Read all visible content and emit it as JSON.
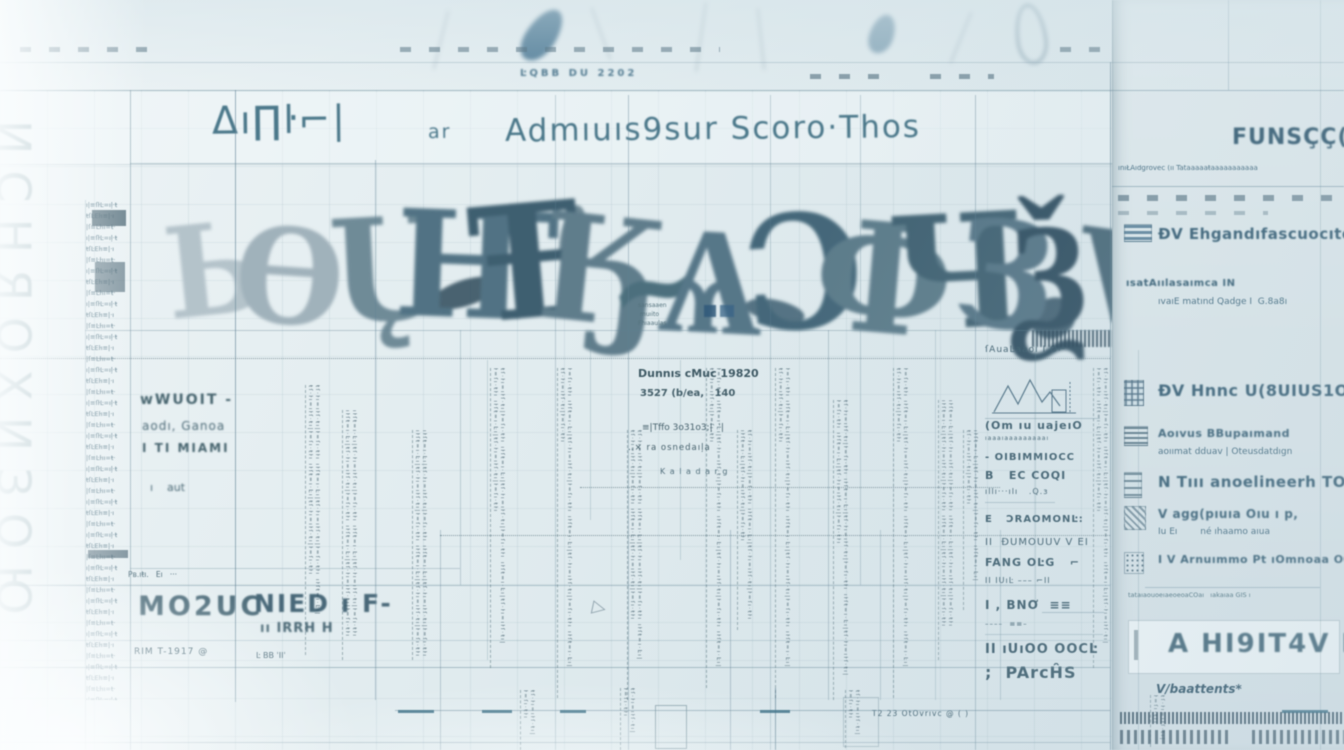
{
  "header": {
    "glyph_prefix": "Δı∏ŀ⌐|",
    "pre_word": "ar",
    "title": "Admıuıs9sur Scoro·Thos"
  },
  "calligraphy": {
    "glyphs": [
      "Ь",
      "Ө",
      "Ų",
      "Ҥ",
      "Ŧ",
      "Ӄ",
      "~",
      "Ѧ",
      "Ɔ",
      "Ф",
      "Ч",
      "З",
      "Ѯ",
      "Ѵ"
    ]
  },
  "left_margin": {
    "vertical_text": "ИСНЯОХИЗОЮ"
  },
  "micro": {
    "rows": [
      "ı|≡ſŀĿ=ıļ·ŧ",
      "ŧſĿEŀı≡|·ı",
      "|ſ≡Ŀŀıı=ŧ·"
    ],
    "column_text": "ıŀſŧ=ı·Ŀı|ŧſ·ŀı=ıŀſ·ŧı|ŀ=ſı·ŧŀı"
  },
  "left_box": {
    "l1": "wWUOIT -",
    "l2": "aodı, Ganoa",
    "l3": "I TI MIAMI",
    "l4": "ı    aut"
  },
  "bottom_left": {
    "tiny_row": "Pʙ.ıŧı.   Eı   ···",
    "cell1": "MO2UC",
    "cell2": "NIED ı F-",
    "cell2_sub": "ıı IRRH H",
    "row1": "RIM T-1917 @",
    "row2": "Ŀ BB ˈIIˈ"
  },
  "center_block": {
    "l1": "Dunnıs cMuc 19820",
    "l2": "3527 (b/ea,   140",
    "l3": "≡|Tffo 3o31o3;|  ˈ|",
    "l4": "‥× ra osnedaıļa",
    "l5": "K a l a d a r g"
  },
  "center_small": {
    "a": "sansaaen",
    "b": "muıito",
    "c": "Fhıaaulas"
  },
  "mid_column": {
    "rows": [
      "ſAuaĿaaoı I O⌐",
      "(Om ıu uajeıO",
      "ıaaaıaaaaaaaaaı",
      "- OIBIMMIOCC",
      "B   EC COQI",
      "ıllı···ılı   .Q.ɜ",
      "E   ƆRAOMONĿ:",
      "II  ĐUMOUUV V EI",
      "FANG OĿG   ⌐",
      "II IUıĿ ––– ⌐II",
      "I , BNƠ  ≡≡",
      "––––  ≡≡–",
      "II ıUıOO OOCĿ",
      ";  PArcĤS"
    ]
  },
  "right_panel": {
    "header": "FUNSÇÇ((",
    "subline": "ınıŁAıdgrovec (ıı Tataaaaaŧaaaaaaaaaaa",
    "items": [
      {
        "label": "ĐV Ehgandıfascuocıto(",
        "sub": "",
        "icon": "list-stripes-icon"
      },
      {
        "label": "ısatAıılasaımca IN",
        "sub": "ıvaıE matınd Qadge I  G.8a8ı",
        "icon": ""
      },
      {
        "label": "ĐV Hnnc U(8UIUS1OI",
        "sub": "",
        "icon": "table-grid-icon"
      },
      {
        "label": "Aoıvus BBupaımand",
        "sub": "aoıımat dduav | Oteusdatdıgn",
        "icon": "stacked-lines-icon"
      },
      {
        "label": "N Tııı anoelineerh TO",
        "sub": "",
        "icon": "ruled-block-icon"
      },
      {
        "label": "V agg(pıuıa Oıu ı p,",
        "sub": "Iu Eı        né ıhaamo aıua",
        "icon": "hatch-block-icon"
      },
      {
        "label": "I V Arnuımmo Pt ıOmnoaa OOI",
        "sub": "",
        "icon": "dotted-block-icon"
      }
    ],
    "footnote": "tataıaouoeıaeoeoaCOaı   ıakaıaa GIS ı",
    "banner": "A HI9IT4V IO(",
    "signature": "V/baattents*"
  },
  "top": {
    "code": "ĿQBB DU 2202"
  },
  "bottom": {
    "note": "T2 23 OtOvrıvc @ ( )"
  },
  "colors": {
    "accent_blue": "#2e6587",
    "ink_dark": "#2f5264",
    "ink_mid": "#4a7080",
    "ink_light": "#8fa8b4",
    "panel_bg": "#dde9ee",
    "line": "#6e91a3"
  }
}
